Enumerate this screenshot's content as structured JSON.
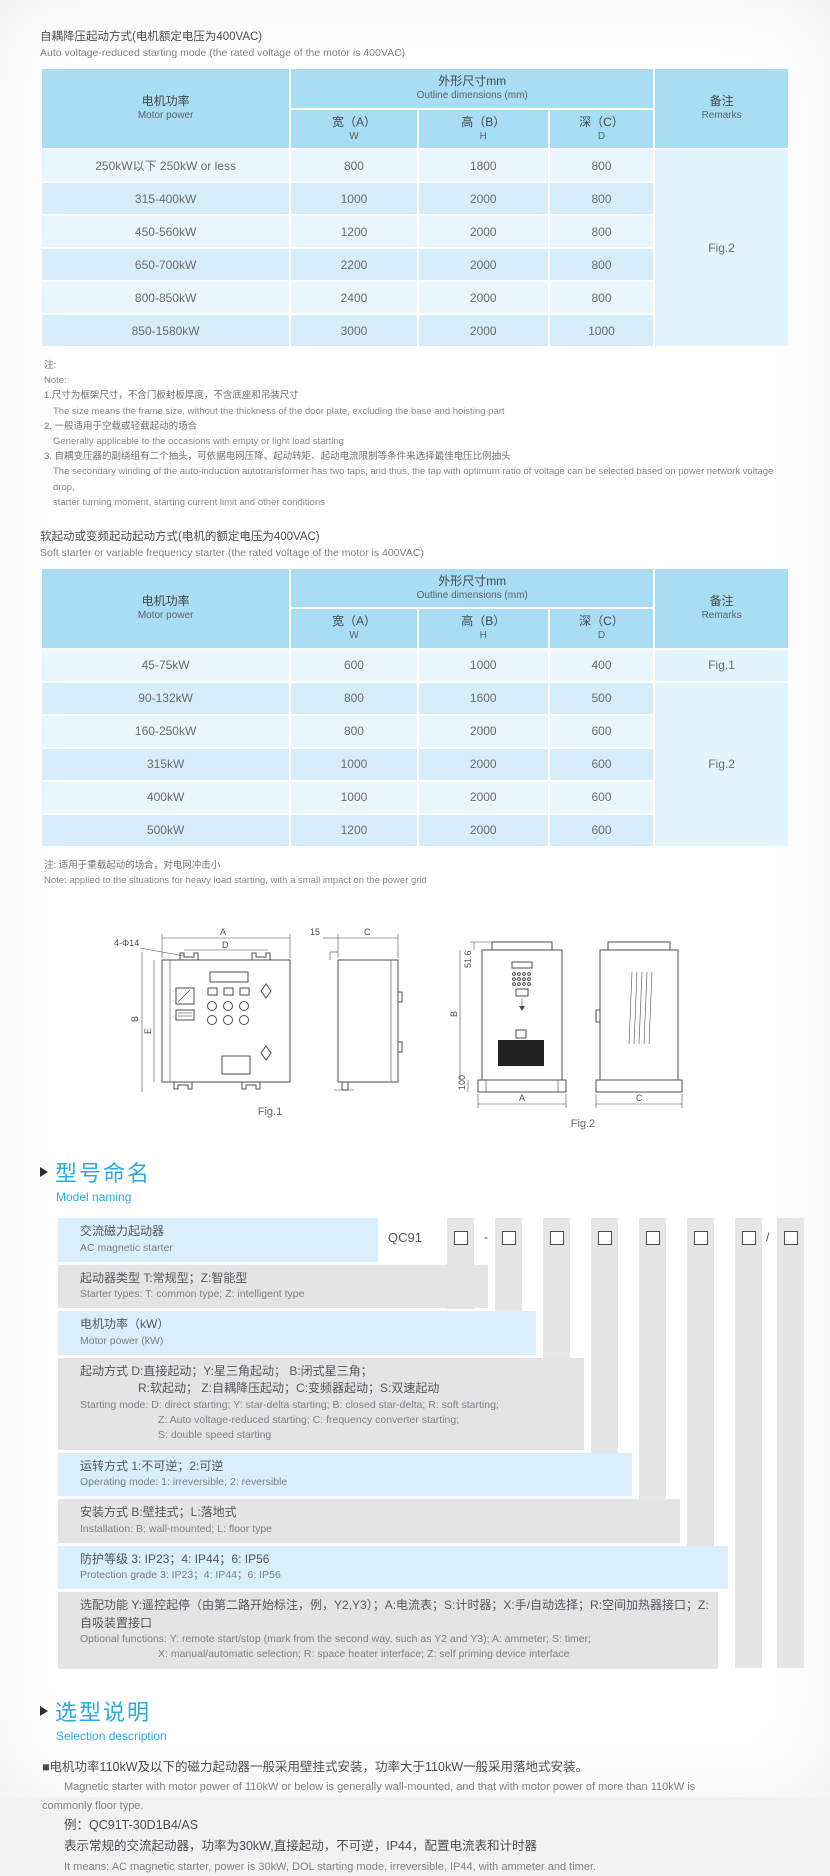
{
  "section_auto": {
    "title_zh": "自耦降压起动方式(电机额定电压为400VAC)",
    "title_en": "Auto voltage-reduced starting mode (the rated voltage of the motor is 400VAC)",
    "header": {
      "motor_zh": "电机功率",
      "motor_en": "Motor power",
      "dims_zh": "外形尺寸mm",
      "dims_en": "Outline dimensions (mm)",
      "w_zh": "宽（A）",
      "w_en": "W",
      "h_zh": "高（B）",
      "h_en": "H",
      "d_zh": "深（C）",
      "d_en": "D",
      "remarks_zh": "备注",
      "remarks_en": "Remarks"
    },
    "rows": [
      {
        "power": "250kW以下 250kW or less",
        "w": "800",
        "h": "1800",
        "d": "800"
      },
      {
        "power": "315-400kW",
        "w": "1000",
        "h": "2000",
        "d": "800"
      },
      {
        "power": "450-560kW",
        "w": "1200",
        "h": "2000",
        "d": "800"
      },
      {
        "power": "650-700kW",
        "w": "2200",
        "h": "2000",
        "d": "800"
      },
      {
        "power": "800-850kW",
        "w": "2400",
        "h": "2000",
        "d": "800"
      },
      {
        "power": "850-1580kW",
        "w": "3000",
        "h": "2000",
        "d": "1000"
      }
    ],
    "remark": "Fig.2",
    "notes": {
      "label_zh": "注:",
      "label_en": "Note:",
      "n1_zh": "1.尺寸为框架尺寸，不含门板封板厚度，不含底座和吊装尺寸",
      "n1_en": "The size means the frame size, without the thickness of the door plate, excluding the base and hoisting part",
      "n2_zh": "2. 一般适用于空载或轻载起动的场合",
      "n2_en": "Generally applicable to the occasions with empty or light load starting",
      "n3_zh": "3. 自耦变压器的副绕组有二个抽头，可依据电网压降、起动转矩、起动电流限制等条件来选择最佳电压比例抽头",
      "n3_en1": "The secondary winding of the auto-induction autotransformer has two taps, and thus, the tap with optimum ratio of voltage can be selected based on power network voltage drop,",
      "n3_en2": "starter turning moment, starting current limit and other conditions"
    }
  },
  "section_soft": {
    "title_zh": "软起动或变频起动起动方式(电机的额定电压为400VAC)",
    "title_en": "Soft starter or variable frequency starter (the rated voltage of the motor is 400VAC)",
    "header": {
      "motor_zh": "电机功率",
      "motor_en": "Motor power",
      "dims_zh": "外形尺寸mm",
      "dims_en": "Outline dimensions (mm)",
      "w_zh": "宽（A）",
      "w_en": "W",
      "h_zh": "高（B）",
      "h_en": "H",
      "d_zh": "深（C）",
      "d_en": "D",
      "remarks_zh": "备注",
      "remarks_en": "Remarks"
    },
    "rows": [
      {
        "power": "45-75kW",
        "w": "600",
        "h": "1000",
        "d": "400"
      },
      {
        "power": "90-132kW",
        "w": "800",
        "h": "1600",
        "d": "500"
      },
      {
        "power": "160-250kW",
        "w": "800",
        "h": "2000",
        "d": "600"
      },
      {
        "power": "315kW",
        "w": "1000",
        "h": "2000",
        "d": "600"
      },
      {
        "power": "400kW",
        "w": "1000",
        "h": "2000",
        "d": "600"
      },
      {
        "power": "500kW",
        "w": "1200",
        "h": "2000",
        "d": "600"
      }
    ],
    "remark_fig1": "Fig.1",
    "remark_fig2": "Fig.2",
    "note_zh": "注: 适用于重载起动的场合，对电网冲击小",
    "note_en": "Note: applied to the situations for heavy load starting, with a small impact on the power grid"
  },
  "figures": {
    "fig1": {
      "label": "Fig.1",
      "dim_a": "A",
      "dim_d": "D",
      "dim_b": "B",
      "dim_e": "E",
      "dim_c": "C",
      "dim_offset": "15",
      "holes": "4-Φ14"
    },
    "fig2": {
      "label": "Fig.2",
      "dim_a": "A",
      "dim_b": "B",
      "dim_c": "C",
      "dim_top": "51.6",
      "dim_bottom": "100"
    }
  },
  "model_naming": {
    "heading_zh": "型号命名",
    "heading_en": "Model naming",
    "code": "QC91",
    "sign_minus": "-",
    "sign_slash": "/",
    "row1": {
      "zh": "交流磁力起动器",
      "en": "AC magnetic starter"
    },
    "row2": {
      "zh": "起动器类型 T:常规型；Z:智能型",
      "en": "Starter types: T: common type; Z: intelligent type"
    },
    "row3": {
      "zh": "电机功率（kW）",
      "en": "Motor power (kW)"
    },
    "row4": {
      "zh1": "起动方式 D:直接起动；Y:星三角起动；  B:闭式星三角；",
      "zh2": "R:软起动；  Z:自耦降压起动；C:变频器起动；S:双速起动",
      "en1": "Starting mode: D: direct starting; Y: star-delta starting; B: closed star-delta; R: soft starting;",
      "en2": "Z: Auto voltage-reduced starting; C: frequency converter starting;",
      "en3": "S: double speed starting"
    },
    "row5": {
      "zh": "运转方式 1:不可逆；2:可逆",
      "en": "Operating mode: 1: irreversible; 2: reversible"
    },
    "row6": {
      "zh": "安装方式 B:壁挂式；L:落地式",
      "en": "Installation: B: wall-mounted;  L: floor type"
    },
    "row7": {
      "zh": "防护等级 3: IP23；4: IP44；6: IP56",
      "en": "Protection grade  3: IP23；4: IP44；6: IP56"
    },
    "row8": {
      "zh": "选配功能  Y:遥控起停（由第二路开始标注，例，Y2,Y3）；A:电流表；S:计时器；X:手/自动选择；R:空间加热器接口；Z:自吸装置接口",
      "en1": "Optional functions: Y: remote start/stop (mark from the second way, such as Y2 and Y3); A: ammeter; S: timer;",
      "en2": "X: manual/automatic selection; R: space heater interface; Z: self priming device interface"
    }
  },
  "selection": {
    "heading_zh": "选型说明",
    "heading_en": "Selection description",
    "p1_zh": "■电机功率110kW及以下的磁力起动器一般采用壁挂式安装，功率大于110kW一般采用落地式安装。",
    "p1_en1": "Magnetic starter with motor power of 110kW or below is generally wall-mounted, and that with motor power of more than 110kW is",
    "p1_en2": "commonly floor type.",
    "example": "例：QC91T-30D1B4/AS",
    "example_zh": "表示常规的交流起动器，功率为30kW,直接起动，不可逆，IP44，配置电流表和计时器",
    "example_en": "It means: AC magnetic starter, power is 30kW, DOL starting mode, irreversible, IP44, with ammeter and timer."
  }
}
